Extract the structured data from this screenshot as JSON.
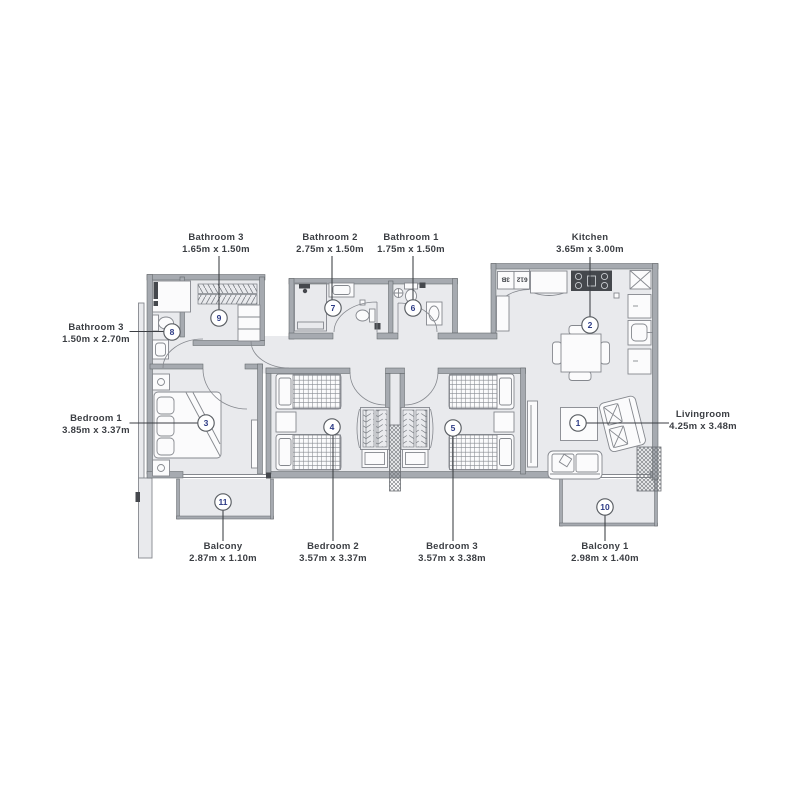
{
  "colors": {
    "floor": "#e9eaed",
    "wall": "#a6aab0",
    "wall_edge": "#606468",
    "line": "#85888e",
    "line_dark": "#5a5e63",
    "dark": "#45484d",
    "text": "#3b3e43",
    "badge_number": "#2c3a85"
  },
  "entry_tag": {
    "unit": "612",
    "type": "3B"
  },
  "rooms": {
    "livingroom": {
      "name": "Livingroom",
      "dims": "4.25m x 3.48m",
      "badge": "1"
    },
    "kitchen": {
      "name": "Kitchen",
      "dims": "3.65m x 3.00m",
      "badge": "2"
    },
    "bedroom1": {
      "name": "Bedroom 1",
      "dims": "3.85m x 3.37m",
      "badge": "3"
    },
    "bedroom2": {
      "name": "Bedroom 2",
      "dims": "3.57m x 3.37m",
      "badge": "4"
    },
    "bedroom3": {
      "name": "Bedroom 3",
      "dims": "3.57m x 3.38m",
      "badge": "5"
    },
    "bathroom1": {
      "name": "Bathroom 1",
      "dims": "1.75m x 1.50m",
      "badge": "6"
    },
    "bathroom2": {
      "name": "Bathroom 2",
      "dims": "2.75m x 1.50m",
      "badge": "7"
    },
    "bathroom3_ensuite": {
      "name": "Bathroom 3",
      "dims": "1.50m x 2.70m",
      "badge": "8"
    },
    "bathroom3_closet": {
      "name": "Bathroom 3",
      "dims": "1.65m x 1.50m",
      "badge": "9"
    },
    "balcony1": {
      "name": "Balcony 1",
      "dims": "2.98m x 1.40m",
      "badge": "10"
    },
    "balcony": {
      "name": "Balcony",
      "dims": "2.87m x 1.10m",
      "badge": "11"
    }
  }
}
